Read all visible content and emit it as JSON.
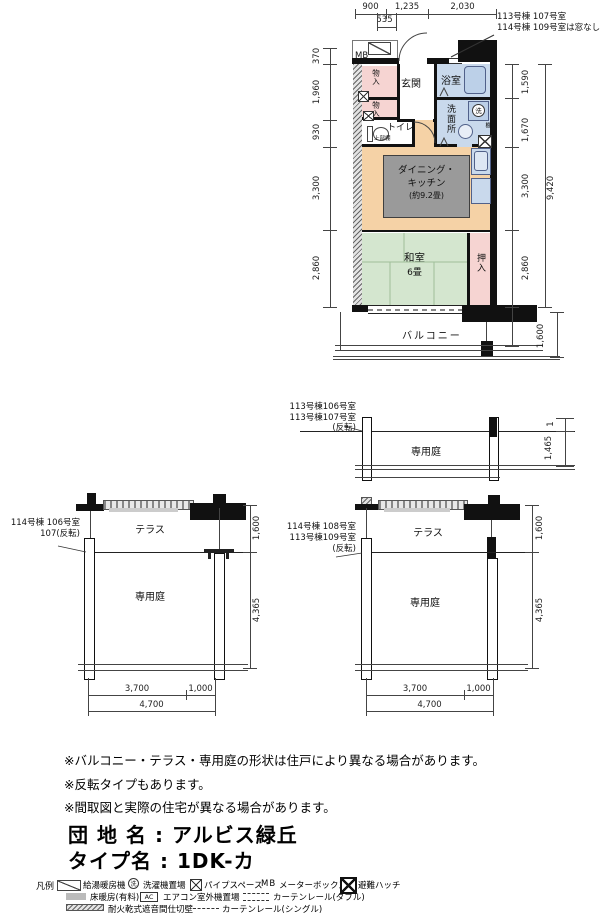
{
  "main_plan": {
    "dims_top": [
      "900",
      "1,235",
      "2,030"
    ],
    "dim_535": "535",
    "annotation": [
      "113号棟 107号室",
      "114号棟 109号室は窓なし"
    ],
    "dims_left": [
      "370",
      "1,960",
      "930",
      "3,300",
      "2,860"
    ],
    "dims_right": [
      "1,590",
      "1,670",
      "3,300",
      "2,860"
    ],
    "dim_total": "9,420",
    "dim_balcony": "1,600",
    "labels": {
      "mb": "MB",
      "genkan": "玄関",
      "bath": "浴室",
      "storage1": "物入",
      "storage2": "物入",
      "toilet": "トイレ",
      "toilet_shelf": "上部棚",
      "washroom": "洗面所",
      "wash_symbol": "洗",
      "shelf": "棚",
      "dk1": "ダイニング・",
      "dk2": "キッチン",
      "dk3": "(約9.2畳)",
      "washitsu": "和室",
      "washitsu_size": "6畳",
      "oshiire": "押入",
      "balcony": "バルコニー"
    }
  },
  "plan_top_garden": {
    "label": [
      "113号棟106号室",
      "113号棟107号室",
      "(反転)"
    ],
    "garden": "専用庭",
    "dim_small": "1",
    "dim_right": "1,465"
  },
  "plan_left_garden": {
    "label": [
      "114号棟 106号室",
      "107(反転)"
    ],
    "terrace": "テラス",
    "garden": "専用庭",
    "dim_terrace": "1,600",
    "dim_garden": "4,365",
    "dims_bottom": [
      "3,700",
      "1,000",
      "4,700"
    ]
  },
  "plan_right_garden": {
    "label": [
      "114号棟 108号室",
      "113号棟109号室",
      "(反転)"
    ],
    "terrace": "テラス",
    "garden": "専用庭",
    "dim_terrace": "1,600",
    "dim_garden": "4,365",
    "dims_bottom": [
      "3,700",
      "1,000",
      "4,700"
    ]
  },
  "notes": [
    "※バルコニー・テラス・専用庭の形状は住戸により異なる場合があります。",
    "※反転タイプもあります。",
    "※間取図と実際の住宅が異なる場合があります。"
  ],
  "title": {
    "estate_label": "団 地 名",
    "sep": ":",
    "estate_name": "アルビス緑丘",
    "type_label": "タイプ名",
    "type_name": "1DK-カ"
  },
  "legend": {
    "heading": "凡例",
    "water_heater": "給湯暖房機",
    "washer_symbol": "洗",
    "washer": "洗濯機置場",
    "pipe_space": "パイプスペース",
    "mb_abbr": "MB",
    "meter_box": "メーターボックス",
    "escape_hatch": "避難ハッチ",
    "floor_heating": "床暖房(有料)",
    "ac_abbr": "AC",
    "ac_space": "エアコン室外機置場",
    "curtain_double": "カーテンレール(ダブル)",
    "fire_wall": "耐火乾式遮音間仕切壁",
    "curtain_single": "カーテンレール(シングル)"
  },
  "colors": {
    "wall": "#111111",
    "pink": "#f6d4d2",
    "blue": "#c9d9ec",
    "blue_fixture": "#bcd0e8",
    "peach": "#f5d2a6",
    "green": "#d4e6cf",
    "gray_rug": "#9a9a9a"
  }
}
